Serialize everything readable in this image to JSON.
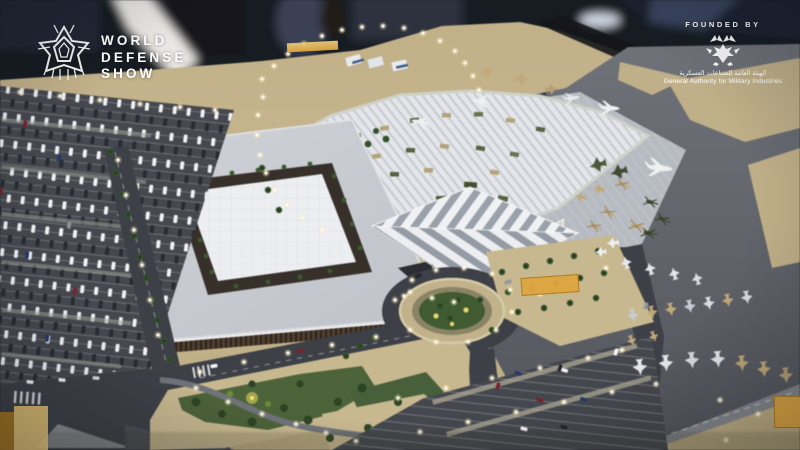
{
  "frame": {
    "width_px": 800,
    "height_px": 450,
    "alt": "Aerial photograph of an illuminated architectural scale model of the World Defense Show exhibition venue: white exhibition halls with a chevron-striped entrance canopy, an outdoor display plaza with military vehicles, palm-lined roads, a landscaped roundabout, car parking lots and rows of model aircraft on a grey apron."
  },
  "branding": {
    "logo_icon": "world-defense-show-star-icon",
    "logo_lines": [
      "WORLD",
      "DEFENSE",
      "SHOW"
    ]
  },
  "founder": {
    "label": "FOUNDED BY",
    "logo_icon": "gami-emblem-icon",
    "org_name_ar": "الهيئة العامة للصناعات العسكرية",
    "org_name_en": "General Authority for Military Industries"
  },
  "palette": {
    "gold": "#dfa640",
    "gold-light": "#e9c878",
    "gold-deep": "#b07c20",
    "sand": "#c6b58c",
    "apron": "#64676d",
    "road": "#3d4046",
    "roof": "#c9ccd1",
    "navy": "#171a22"
  }
}
